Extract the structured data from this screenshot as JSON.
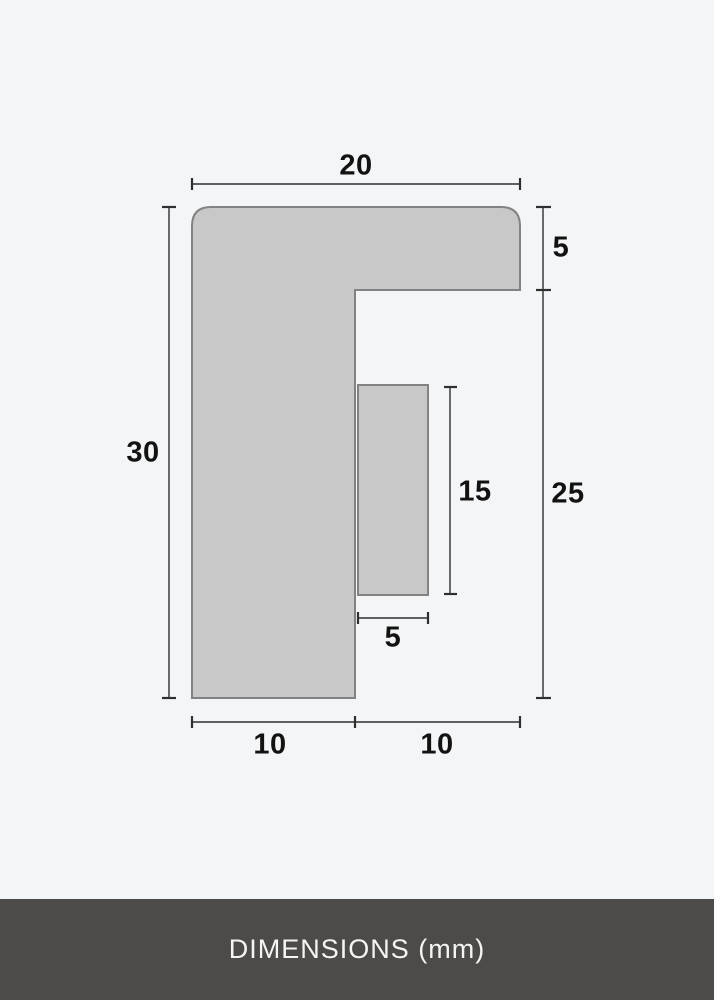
{
  "page": {
    "background_color": "#f4f5f7"
  },
  "diagram": {
    "kind": "cross-section-dimension-drawing",
    "unit": "mm",
    "shape": {
      "fill": "#c8c8c8",
      "stroke": "#828282"
    },
    "line_color": "#2f2f2f",
    "dims": {
      "top_width": "20",
      "flange_height": "5",
      "overall_height": "30",
      "inner_block_height": "15",
      "below_flange_height": "25",
      "inner_block_width": "5",
      "bottom_left_width": "10",
      "bottom_right_width": "10"
    }
  },
  "footer": {
    "label": "DIMENSIONS (mm)",
    "background_color": "#4c4b49",
    "text_color": "#f4f4f3"
  }
}
